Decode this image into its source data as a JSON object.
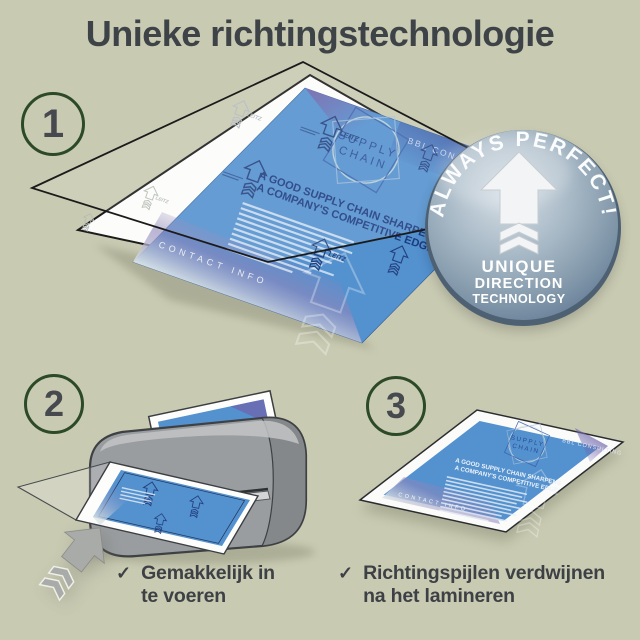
{
  "title": "Unieke richtingstechnologie",
  "badge": {
    "arc_text": "ALWAYS PERFECT!",
    "line1": "UNIQUE",
    "line2": "DIRECTION",
    "line3": "TECHNOLOGY"
  },
  "steps": {
    "one": {
      "number": "1"
    },
    "two": {
      "number": "2",
      "checkmark": "✓",
      "caption_line1": "Gemakkelijk in",
      "caption_line2": "te voeren"
    },
    "three": {
      "number": "3",
      "checkmark": "✓",
      "caption_line1": "Richtingspijlen verdwijnen",
      "caption_line2": "na het lamineren"
    }
  },
  "document": {
    "brand": "LEITZ",
    "logo_line1": "SUPPLY",
    "logo_line2": "CHAIN",
    "headline_line1": "A GOOD SUPPLY CHAIN SHARPENS",
    "headline_line2": "A COMPANY'S COMPETITIVE EDGE",
    "corner_top": "BBL CONSULTING",
    "corner_bottom": "CONTACT INFO"
  },
  "colors": {
    "background": "#c9cab2",
    "title_text": "#3d4347",
    "circle_stroke": "#2c4a28",
    "number_text": "#46494d",
    "document_blue": "#5391cf",
    "arrow_navy": "#24407e",
    "badge_face": "#a9bac7",
    "laminator_gray": "#9a9da0"
  }
}
